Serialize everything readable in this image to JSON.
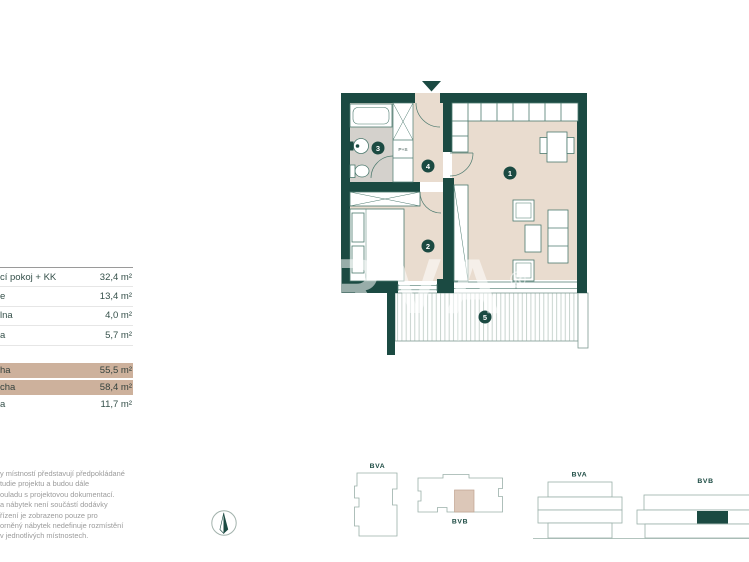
{
  "table": {
    "rows": [
      {
        "label": "cí pokoj + KK",
        "value": "32,4 m²"
      },
      {
        "label": "e",
        "value": "13,4 m²"
      },
      {
        "label": "lna",
        "value": "4,0 m²"
      },
      {
        "label": "a",
        "value": "5,7 m²"
      },
      {
        "label": "ha",
        "value": "55,5 m²"
      },
      {
        "label": "cha",
        "value": "58,4 m²"
      },
      {
        "label": "a",
        "value": "11,7 m²"
      }
    ]
  },
  "disclaimer": {
    "lines": [
      "y místností představují předpokládané",
      "tudie projektu a budou dále",
      "ouladu s projektovou dokumentací.",
      "a nábytek není součástí dodávky",
      "řízení je zobrazeno pouze pro",
      "orněný nábytek nedefinuje rozmístění",
      "v jednotlivých místnostech."
    ]
  },
  "floorplan": {
    "watermark": "ARVA",
    "watermark_reg": "®",
    "rooms": [
      {
        "number": "1"
      },
      {
        "number": "2"
      },
      {
        "number": "3"
      },
      {
        "number": "4"
      },
      {
        "number": "5"
      }
    ],
    "labels": {
      "washer_dryer": "P+S"
    }
  },
  "locators": {
    "plate_a": "BVA",
    "plate_b": "BVB",
    "elev_a": "BVA",
    "elev_b": "BVB"
  },
  "colors": {
    "wall": "#1b4a42",
    "floor": "#e9dccf",
    "bath_floor": "#d4d1cc",
    "highlight_row": "#cdb19c"
  }
}
